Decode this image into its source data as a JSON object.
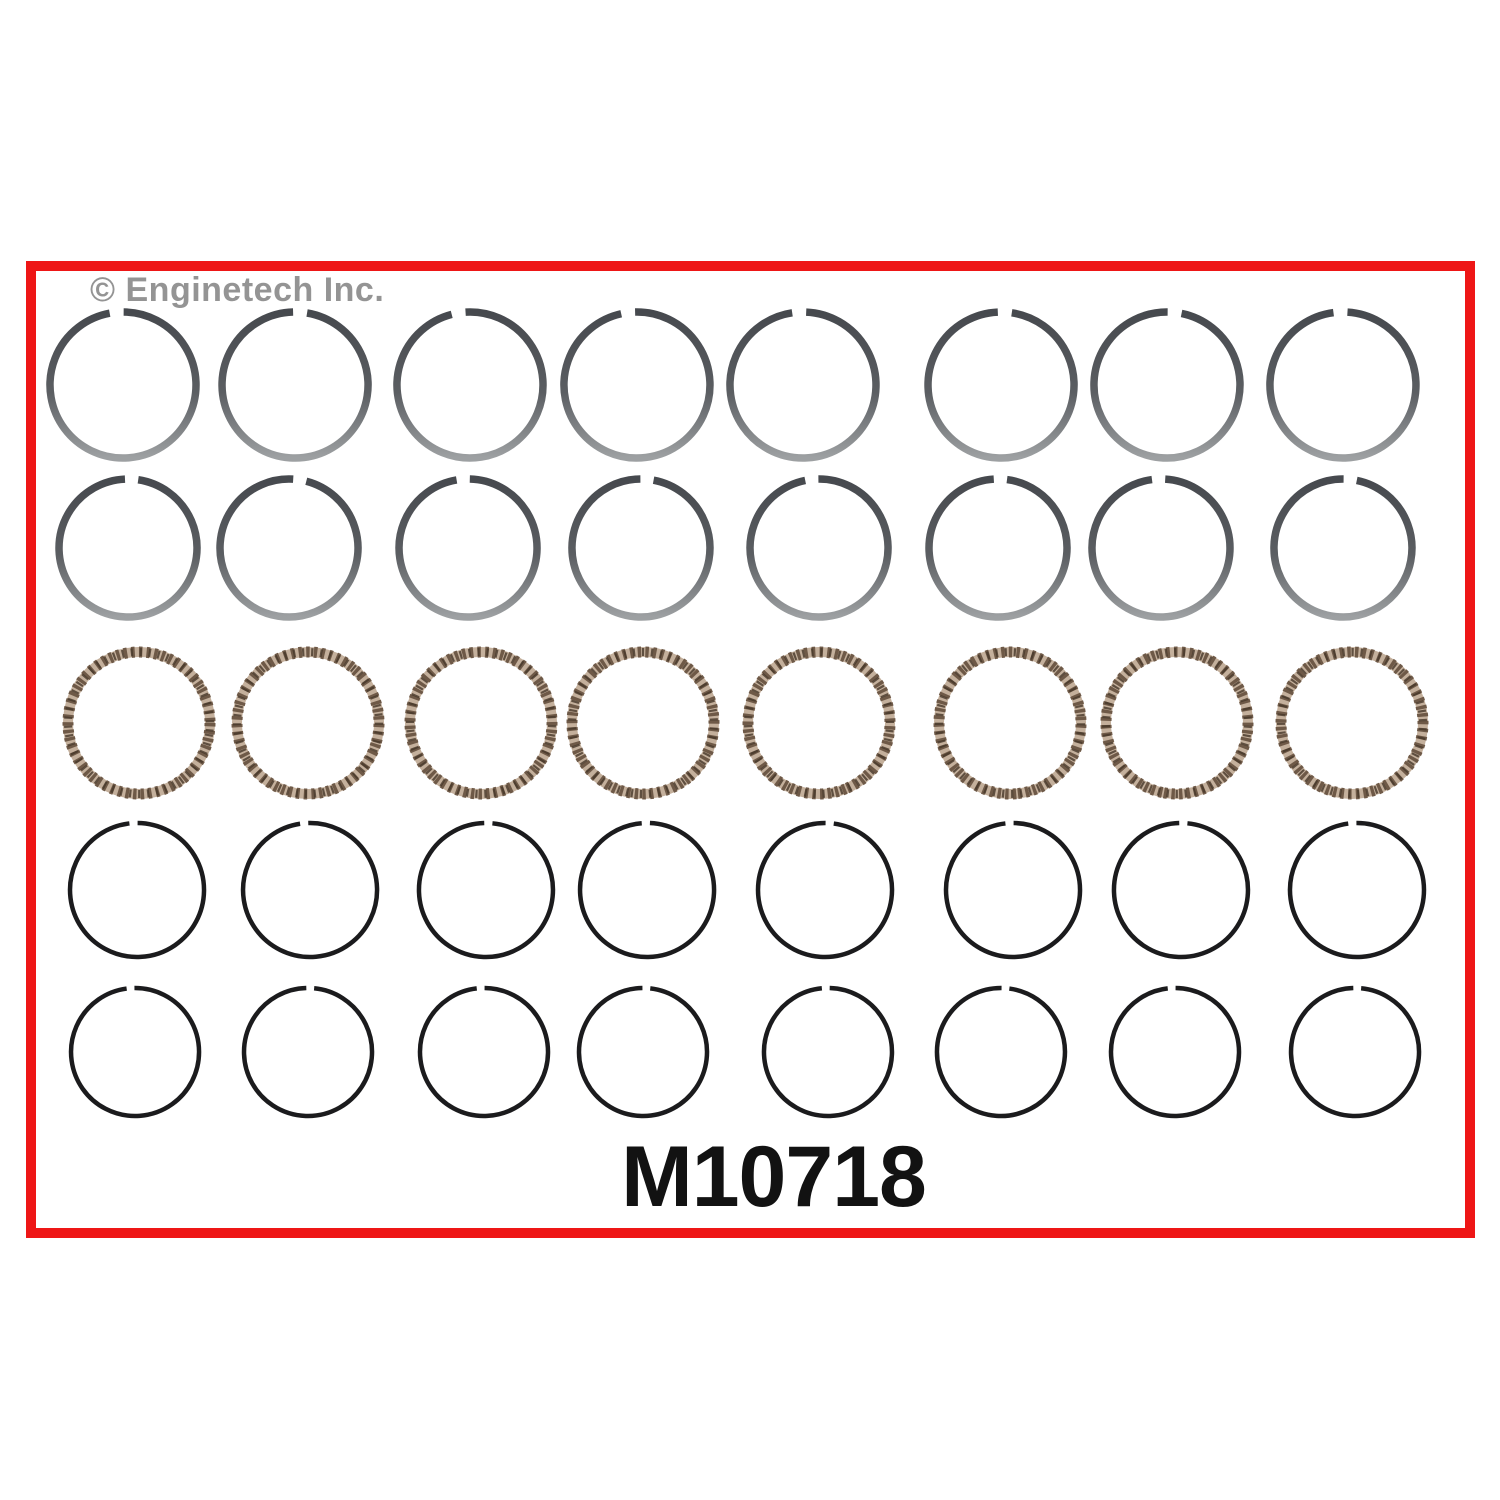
{
  "branding": {
    "watermark": "© Enginetech Inc."
  },
  "part_number": "M10718",
  "colors": {
    "frame_red": "#ee1616",
    "watermark_gray": "#949494",
    "text_black": "#121212",
    "ring_gray_top": "#46494e",
    "ring_gray_mid": "#5b5e62",
    "ring_gray_bottom": "#9da0a2",
    "ring_thin_black": "#1b1b1d",
    "oil_ring_base": "#c4b09c",
    "oil_ring_dash": "#6e5947",
    "oil_ring_dark": "#463729"
  },
  "rings_layout": {
    "rows": [
      {
        "name": "compression-ring-row-1",
        "type": "compression-gray",
        "y": 385,
        "r": 73,
        "stroke": 7.5,
        "gap_width_deg": 11,
        "x_centers": [
          123,
          295,
          470,
          637,
          803,
          1001,
          1167,
          1343
        ],
        "gap_angles_deg": [
          -5,
          4,
          -9,
          -7,
          -3,
          3,
          6,
          -2
        ]
      },
      {
        "name": "compression-ring-row-2",
        "type": "compression-gray",
        "y": 548,
        "r": 69,
        "stroke": 7.5,
        "gap_width_deg": 11,
        "x_centers": [
          128,
          289,
          468,
          641,
          819,
          998,
          1161,
          1343
        ],
        "gap_angles_deg": [
          3,
          9,
          -4,
          5,
          -6,
          2,
          -2,
          6
        ]
      },
      {
        "name": "oil-ring-row",
        "type": "oil",
        "y": 723,
        "r": 71,
        "stroke": 10,
        "gap_width_deg": 0,
        "x_centers": [
          139,
          308,
          481,
          643,
          819,
          1010,
          1177,
          1352
        ],
        "gap_angles_deg": [
          0,
          0,
          0,
          0,
          0,
          0,
          0,
          0
        ]
      },
      {
        "name": "second-compression-ring-row-1",
        "type": "compression-thin",
        "y": 890,
        "r": 67,
        "stroke": 4.5,
        "gap_width_deg": 7,
        "x_centers": [
          137,
          310,
          486,
          647,
          825,
          1013,
          1181,
          1357
        ],
        "gap_angles_deg": [
          -3,
          -5,
          2,
          -1,
          4,
          -3,
          2,
          -4
        ]
      },
      {
        "name": "second-compression-ring-row-2",
        "type": "compression-thin",
        "y": 1052,
        "r": 64,
        "stroke": 4.5,
        "gap_width_deg": 7,
        "x_centers": [
          135,
          308,
          484,
          643,
          828,
          1001,
          1175,
          1355
        ],
        "gap_angles_deg": [
          -4,
          2,
          -3,
          3,
          -2,
          4,
          -3,
          2
        ]
      }
    ]
  }
}
